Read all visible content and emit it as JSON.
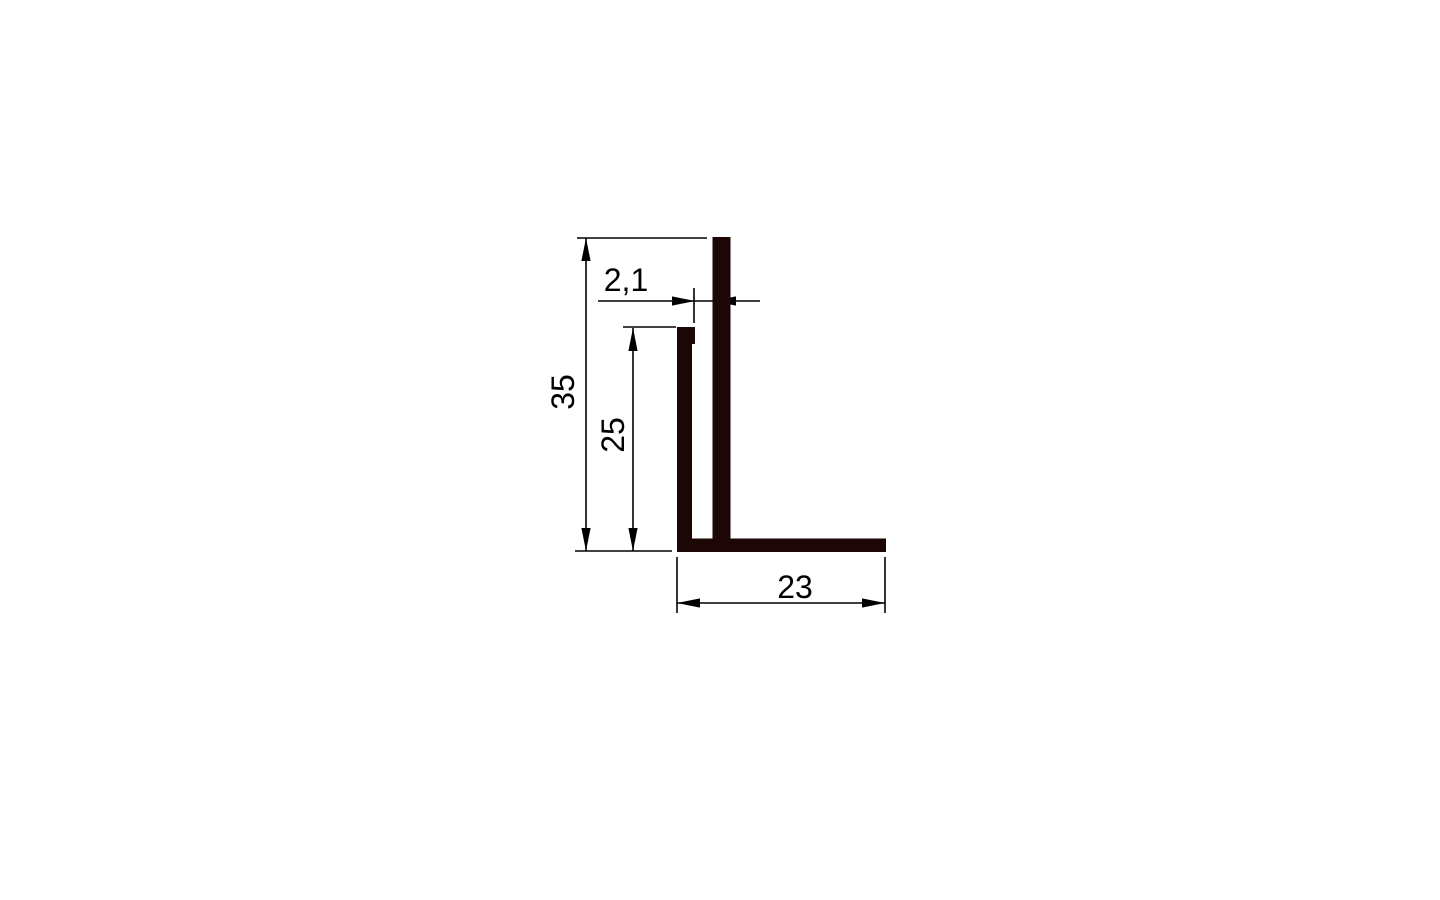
{
  "canvas": {
    "width": 1440,
    "height": 900,
    "background_color": "#ffffff"
  },
  "drawing": {
    "title": "L-profile cross-section with flange slot",
    "colors": {
      "profile_fill": "#1d0606",
      "dimension_line": "#000000",
      "text": "#000000"
    },
    "font_size_px": 32,
    "line_width_px": 1.6,
    "arrow": {
      "length_px": 23,
      "half_width_px": 4.6
    },
    "scale_px_per_mm": 9,
    "profile_shapes": [
      {
        "name": "outer-vertical-wall",
        "x": 712.5,
        "y": 237,
        "w": 18,
        "h": 315
      },
      {
        "name": "inner-vertical-wall",
        "x": 677,
        "y": 327,
        "w": 15,
        "h": 225
      },
      {
        "name": "inner-wall-top-lip",
        "x": 677,
        "y": 327,
        "w": 18,
        "h": 17
      },
      {
        "name": "bottom-flange",
        "x": 677,
        "y": 538.5,
        "w": 209,
        "h": 13.5
      }
    ],
    "dimensions": [
      {
        "id": "dim-height-35",
        "label": "35",
        "value_mm": 35,
        "orientation": "vertical",
        "line": {
          "x1": 586,
          "y1": 238,
          "x2": 586,
          "y2": 551
        },
        "arrows": [
          {
            "x": 586,
            "y": 238,
            "dir": "up"
          },
          {
            "x": 586,
            "y": 551,
            "dir": "down"
          }
        ],
        "extension_lines": [
          {
            "x1": 577,
            "y1": 238,
            "x2": 707,
            "y2": 238
          },
          {
            "x1": 575,
            "y1": 551,
            "x2": 672,
            "y2": 551
          }
        ],
        "label_pos": {
          "x": 563,
          "y": 392,
          "rotation": -90
        }
      },
      {
        "id": "dim-height-25",
        "label": "25",
        "value_mm": 25,
        "orientation": "vertical",
        "line": {
          "x1": 633,
          "y1": 328,
          "x2": 633,
          "y2": 551
        },
        "arrows": [
          {
            "x": 633,
            "y": 328,
            "dir": "up"
          },
          {
            "x": 633,
            "y": 551,
            "dir": "down"
          }
        ],
        "extension_lines": [
          {
            "x1": 623,
            "y1": 327,
            "x2": 676,
            "y2": 327
          }
        ],
        "label_pos": {
          "x": 613,
          "y": 435,
          "rotation": -90
        }
      },
      {
        "id": "dim-gap-2-1",
        "label": "2,1",
        "value_mm": 2.1,
        "orientation": "horizontal",
        "line": {
          "x1": 598,
          "y1": 301,
          "x2": 760,
          "y2": 301
        },
        "arrows": [
          {
            "x": 695,
            "y": 301,
            "dir": "right"
          },
          {
            "x": 713,
            "y": 301,
            "dir": "left"
          }
        ],
        "extension_lines": [
          {
            "x1": 694,
            "y1": 288,
            "x2": 694,
            "y2": 323
          }
        ],
        "label_pos": {
          "x": 626,
          "y": 280,
          "rotation": 0
        }
      },
      {
        "id": "dim-width-23",
        "label": "23",
        "value_mm": 23,
        "orientation": "horizontal",
        "line": {
          "x1": 677,
          "y1": 603,
          "x2": 885,
          "y2": 603
        },
        "arrows": [
          {
            "x": 677,
            "y": 603,
            "dir": "left"
          },
          {
            "x": 885,
            "y": 603,
            "dir": "right"
          }
        ],
        "extension_lines": [
          {
            "x1": 677,
            "y1": 557,
            "x2": 677,
            "y2": 613
          },
          {
            "x1": 885,
            "y1": 557,
            "x2": 885,
            "y2": 613
          }
        ],
        "label_pos": {
          "x": 795,
          "y": 587,
          "rotation": 0
        }
      }
    ]
  }
}
